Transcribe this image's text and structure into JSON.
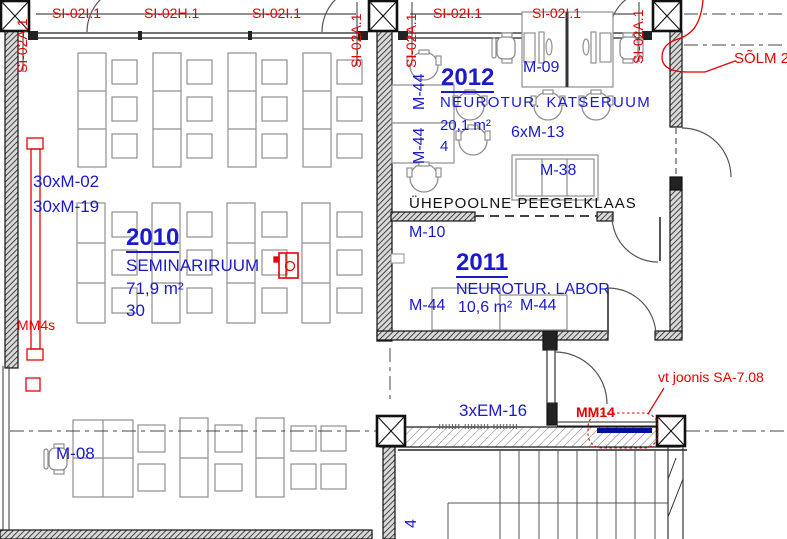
{
  "colors": {
    "tag_red": "#e60000",
    "label_blue": "#1a1acc",
    "mm14_bar_blue": "#000f9e"
  },
  "wall_tags": {
    "top": [
      "SI-02I.1",
      "SI-02H.1",
      "SI-02I.1",
      "SI-02I.1",
      "SI-02I.1"
    ],
    "vertical": [
      "SI-02A.1",
      "SI-02A.1",
      "SI-02A.1",
      "SI-02A.1"
    ]
  },
  "rooms": {
    "r2010": {
      "number": "2010",
      "name": "SEMINARIRUUM",
      "area": "71,9 m²",
      "capacity": "30",
      "furniture_a": "30xM-02",
      "furniture_b": "30xM-19",
      "device": "MM4s"
    },
    "r2012": {
      "number": "2012",
      "name": "NEUROTUR. KATSERUUM",
      "area": "20,1 m²",
      "capacity": "4",
      "chairs": "6xM-13",
      "workstation": "M-09",
      "table": "M-38",
      "door_a": "M-44",
      "door_b": "M-44",
      "glass_note": "ÜHEPOOLNE PEEGELKLAAS"
    },
    "r2011": {
      "number": "2011",
      "name": "NEUROTUR. LABOR",
      "area": "10,6 m²",
      "door_left": "M-44",
      "door_right": "M-44",
      "door_top": "M-10"
    }
  },
  "bottom": {
    "radiators": "3xEM-16",
    "workstation": "M-08",
    "mm14": "MM14",
    "note": "vt joonis SA-7.08",
    "stair_tag": "4"
  },
  "callouts": {
    "solm": "SÕLM 2"
  }
}
